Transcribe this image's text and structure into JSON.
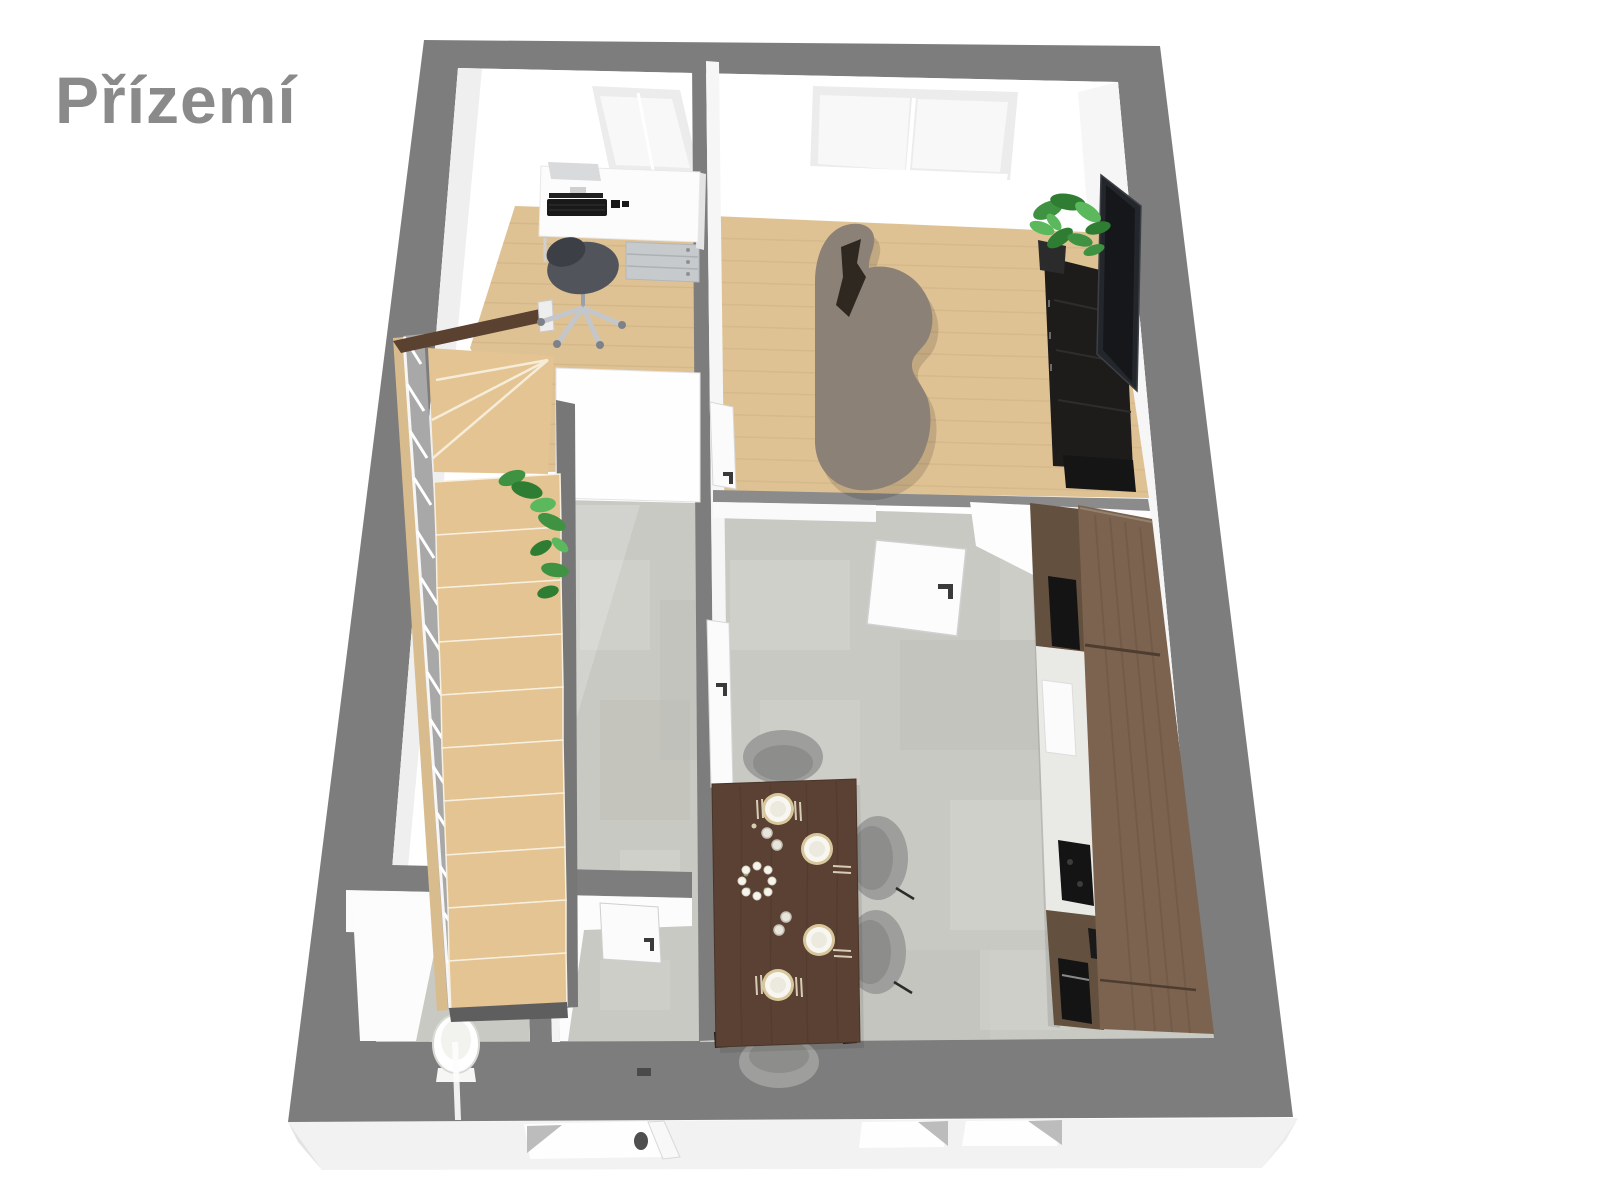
{
  "title": "Přízemí",
  "colors": {
    "background": "#ffffff",
    "title_text": "#8a8a8a",
    "exterior_wall": "#7d7d7d",
    "exterior_skirt": "#f2f2f2",
    "skirt_shadow": "#bcbcbc",
    "interior_wall": "#ffffff",
    "wall_shade": "#efefef",
    "interior_wall_top": "#8b8b8b",
    "wood_floor": "#dfc294",
    "wood_plank_line": "#cdb083",
    "concrete_floor": "#c9c9c4",
    "concrete_light": "#d8d8d2",
    "concrete_dark": "#b9b9b3",
    "stair_tread": "#e3c492",
    "stair_handrail": "#5a4130",
    "stair_baluster_band": "#a8a8a8",
    "stair_stringer": "#777777",
    "stair_side_wood": "#d8bc8e",
    "sofa": "#8c8176",
    "sofa_cushion": "#2e2821",
    "desk": "#fcfcfc",
    "desk_shelf": "#d9dadb",
    "drawer_unit": "#c7cacd",
    "keyboard": "#191919",
    "office_chair": "#51555b",
    "office_chair_back": "#3c4046",
    "chair_base": "#c3c7cc",
    "window_frame": "#ececec",
    "window_pane": "#f8f8f8",
    "tv": "#23262b",
    "tv_screen": "#15171b",
    "tv_cabinet": "#1d1c1b",
    "media_unit_low": "#151515",
    "plant_green": "#3f9242",
    "plant_green_dark": "#2e7d32",
    "plant_green_light": "#5cb85c",
    "plant_pot": "#2b2b2b",
    "kitchen_cabinet_top": "#7b6350",
    "kitchen_cabinet_front": "#64503f",
    "kitchen_split_line": "#4e3d2f",
    "kitchen_appliance": "#141414",
    "counter": "#e9e9e6",
    "counter_block": "#fbfbfb",
    "dining_table": "#5a4133",
    "table_leg": "#211913",
    "dining_chair": "#9e9e9c",
    "dining_chair_shade": "#8d8d8b",
    "plate_rim": "#d9c79c",
    "plate": "#f8f6f0",
    "plate_center": "#eceadf",
    "cutlery": "#d6cdb4",
    "glass": "#e8e5dc",
    "flower": "#f6f4ec",
    "door_leaf": "#fbfbfb",
    "door_edge": "#d5d5d5",
    "door_handle": "#3a3a3a",
    "toilet": "#ffffff",
    "toilet_outline": "#dadad6"
  },
  "scene": {
    "floor_label": "Přízemí",
    "rooms": [
      {
        "name": "office",
        "floor_material": "wood",
        "items": [
          "desk",
          "keyboard",
          "drawer-unit",
          "office-chair",
          "window"
        ]
      },
      {
        "name": "living-room",
        "floor_material": "wood",
        "items": [
          "curved-sofa",
          "sofa-cushion",
          "tv",
          "tv-cabinet",
          "potted-plant",
          "double-window"
        ]
      },
      {
        "name": "hallway-stairs",
        "floor_material": "concrete",
        "items": [
          "staircase",
          "winder-steps",
          "handrail",
          "baluster-railing",
          "plant-under-stairs"
        ]
      },
      {
        "name": "kitchen-dining",
        "floor_material": "concrete",
        "items": [
          "kitchen-cabinet-run",
          "cooktop",
          "oven",
          "counter",
          "dining-table",
          "dining-chairs",
          "place-settings",
          "flower-centerpiece",
          "interior-door"
        ]
      },
      {
        "name": "wc",
        "floor_material": "concrete",
        "items": [
          "toilet"
        ]
      },
      {
        "name": "entry",
        "floor_material": "concrete",
        "items": [
          "interior-door"
        ]
      }
    ],
    "counts": {
      "dining_chairs": 4,
      "place_settings": 4,
      "straight_stair_treads": 10,
      "interior_door_leaves": 4,
      "exterior_bottom_windows": 2
    }
  }
}
